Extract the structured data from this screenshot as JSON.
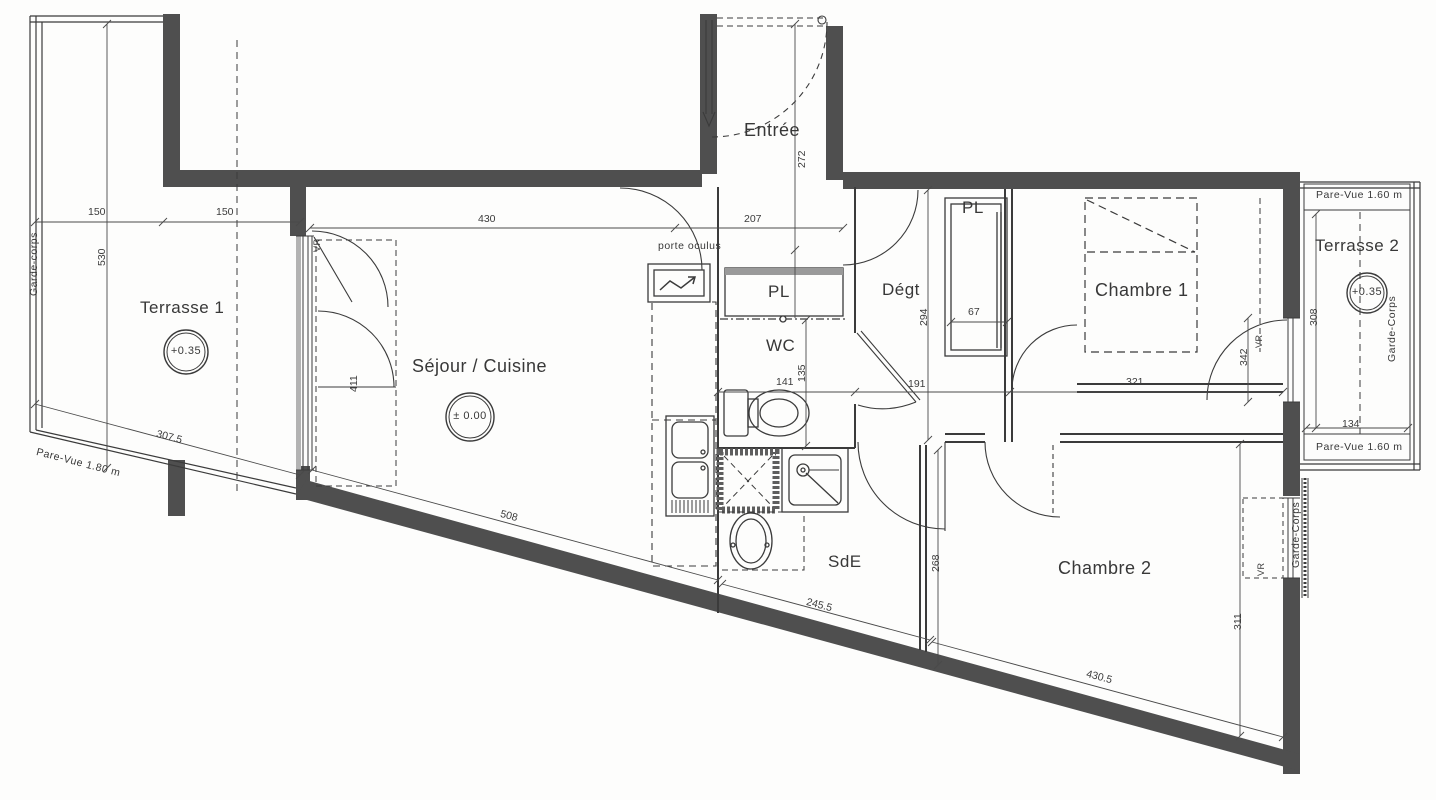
{
  "rooms": {
    "terrasse1": "Terrasse 1",
    "terrasse2": "Terrasse 2",
    "sejour": "Séjour / Cuisine",
    "entree": "Entrée",
    "pl1": "PL",
    "pl2": "PL",
    "degt": "Dégt",
    "wc": "WC",
    "chambre1": "Chambre 1",
    "sde": "SdE",
    "chambre2": "Chambre 2"
  },
  "levels": {
    "terrasse1": "+0.35",
    "sejour": "± 0.00",
    "terrasse2": "+0.35"
  },
  "dims": {
    "t1_width_a": "150",
    "t1_width_b": "150",
    "t1_length": "530",
    "t1_bottom": "307.5",
    "sejour_top": "430",
    "entree_top": "207",
    "entree_depth": "272",
    "sejour_window": "411",
    "degt_depth": "294",
    "pl2_width": "67",
    "degt_width": "191",
    "wc_width": "141",
    "wc_depth": "135",
    "ch1_width": "321",
    "ch1_window": "342",
    "sejour_bottom": "508",
    "sde_bottom": "245.5",
    "sde_wall": "268",
    "ch2_bottom": "430.5",
    "ch2_window": "311",
    "t2_length": "308",
    "t2_width": "134"
  },
  "annotations": {
    "garde_corps_t1": "Garde-corps",
    "garde_corps_t2": "Garde-Corps",
    "garde_corps_ch2": "Garde-Corps",
    "pare_vue_t1": "Pare-Vue 1.80 m",
    "pare_vue_t2_top": "Pare-Vue 1.60 m",
    "pare_vue_t2_bottom": "Pare-Vue 1.60 m",
    "porte_oculus": "porte oculus",
    "vr_sejour": "VR",
    "vr_ch1": "VR",
    "vr_ch2": "VR"
  }
}
